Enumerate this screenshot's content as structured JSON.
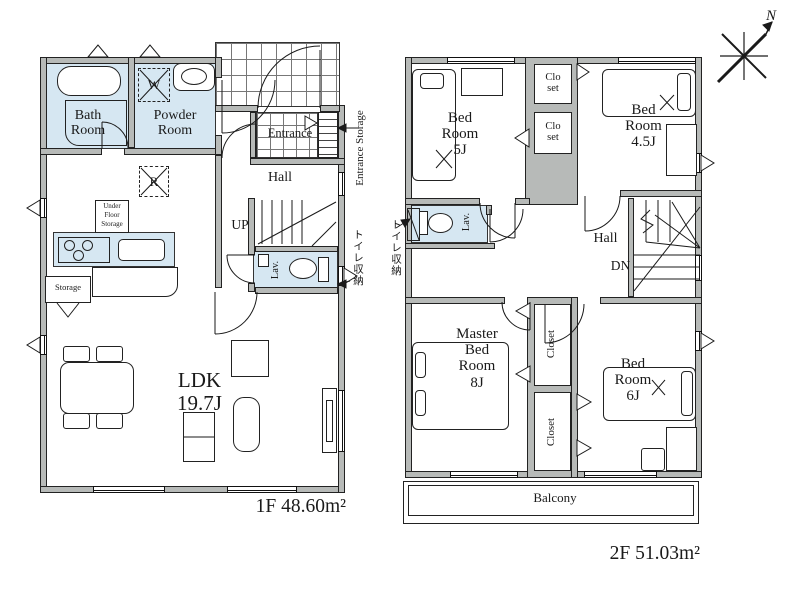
{
  "compass": {
    "north": "N"
  },
  "floor1": {
    "area_label": "1F 48.60m²",
    "rooms": {
      "bath": "Bath\nRoom",
      "powder": "Powder\nRoom",
      "entrance": "Entrance",
      "hall": "Hall",
      "lav": "Lav.",
      "ldk": "LDK\n19.7J",
      "storage": "Storage",
      "under_floor": "Under\nFloor\nStorage"
    },
    "stairs_up": "UP",
    "washer": "W",
    "fridge": "R",
    "annotations": {
      "entrance_storage": "Entrance Storage",
      "toilet_storage": "トイレ収納"
    }
  },
  "floor2": {
    "area_label": "2F 51.03m²",
    "rooms": {
      "bed5": "Bed\nRoom\n5J",
      "bed45": "Bed\nRoom\n4.5J",
      "master": "Master\nBed\nRoom\n8J",
      "bed6": "Bed\nRoom\n6J",
      "closet_small": "Clo\nset",
      "closet": "Closet",
      "lav": "Lav.",
      "hall": "Hall",
      "balcony": "Balcony"
    },
    "stairs_down": "DN",
    "annotations": {
      "toilet_storage": "トイレ収納"
    }
  }
}
